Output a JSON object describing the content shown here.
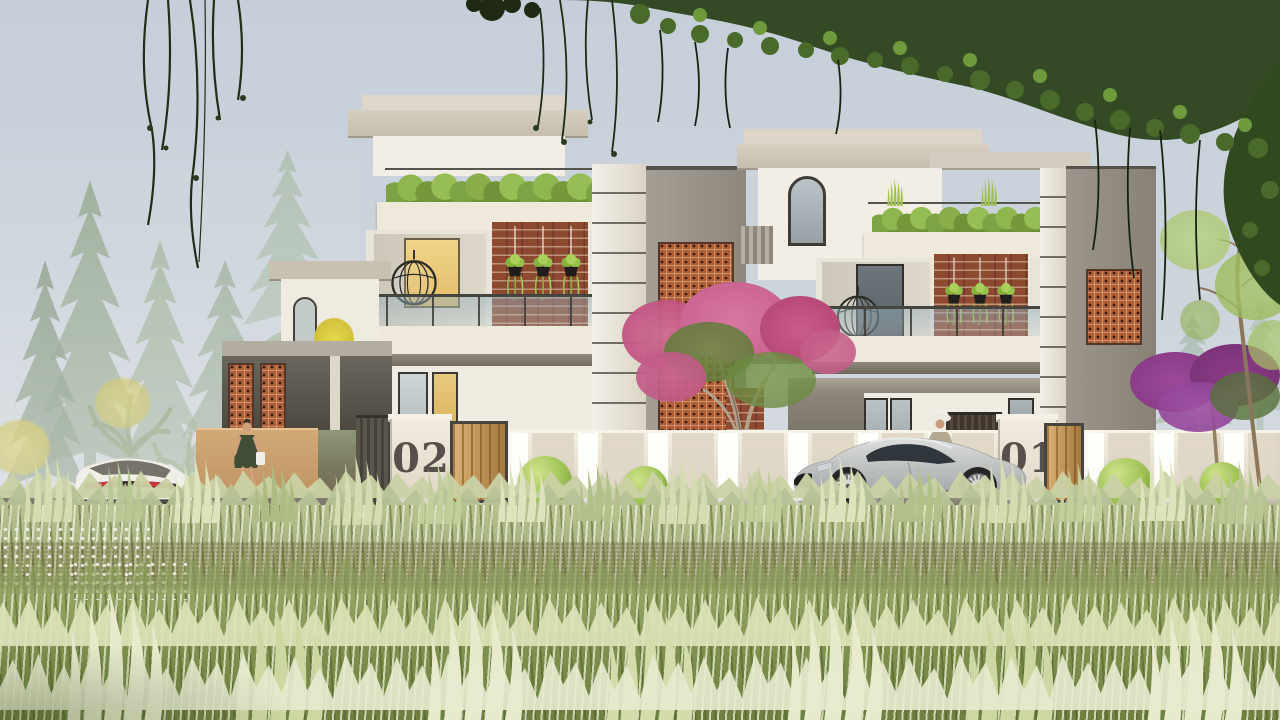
{
  "scene": {
    "type": "architectural-exterior-render",
    "description": "Photorealistic render of two modern twin villas with rooftop planters, brick and jali accent panels, compound wall with numbered gate pillars, parked cars, pedestrians and a tall grass meadow in the foreground",
    "villa_left": {
      "number": "02"
    },
    "villa_right": {
      "number": "01"
    }
  },
  "palette": {
    "sky_top": "#c6cfd9",
    "sky_bottom": "#dfe2df",
    "wall_white": "#f1ece2",
    "roof_slab": "#d6cfc1",
    "travertine": "#eae3d3",
    "brick": "#8d4a31",
    "jali_terracotta": "#ad5c34",
    "wood_gate": "#c49452",
    "hedge_green": "#86ab46",
    "grass_light": "#dfe5c0",
    "grass_dark": "#6d7f41",
    "house_number": "#57504a",
    "car_silver": "#c0c3c3",
    "car_white": "#f0eee8",
    "bougainvillea_pink": "#c25583",
    "flower_purple": "#8c3c88",
    "dress_olive": "#424d36",
    "canopy_dark_green": "#2e451f"
  }
}
